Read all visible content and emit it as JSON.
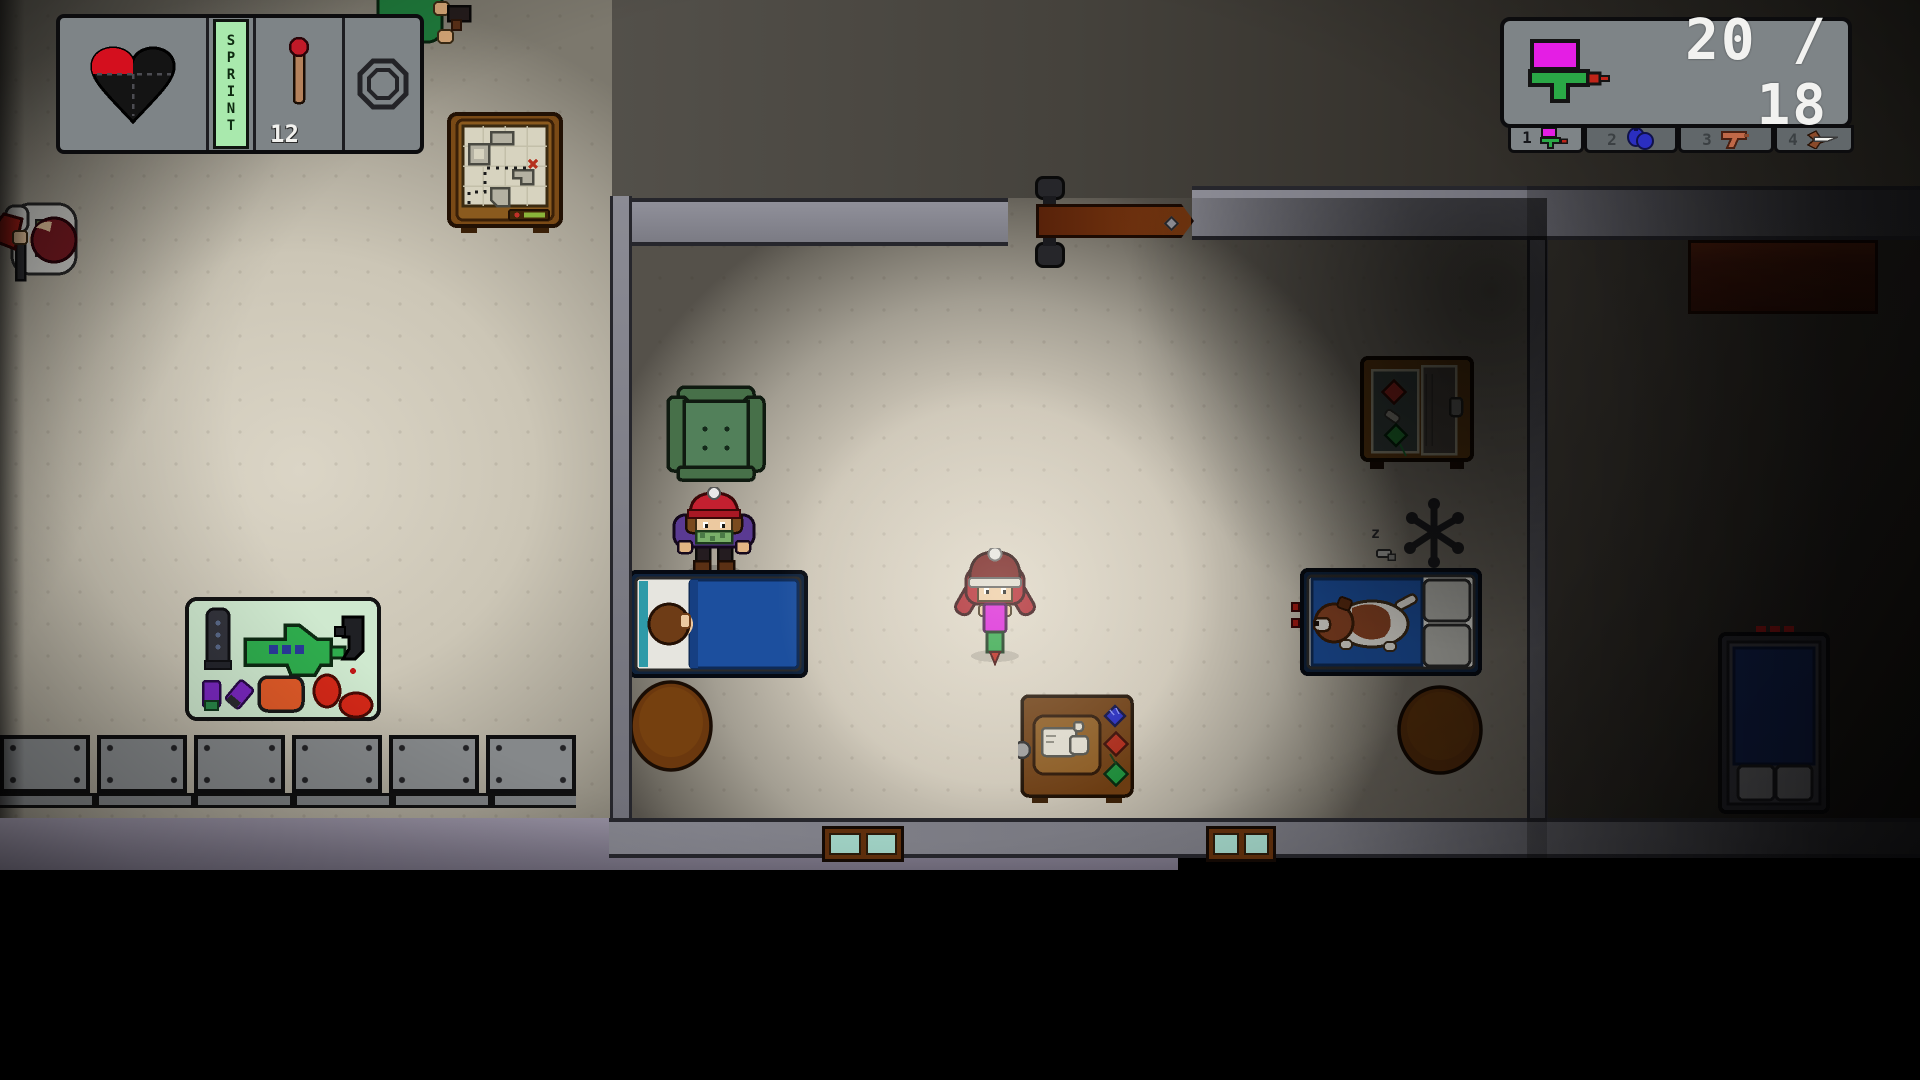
{
  "hud": {
    "status_panel": {
      "health_icon": "quartered-heart",
      "sprint_label": "SPRINT",
      "match_count": "12",
      "gear_icon": "octagon-ring"
    },
    "ammo_panel": {
      "weapon_icon": "watergun",
      "ammo_text": "20 / 18",
      "slots": [
        {
          "number": "1",
          "item_icon": "watergun",
          "active": true
        },
        {
          "number": "2",
          "item_icon": "water-balloons",
          "active": false
        },
        {
          "number": "3",
          "item_icon": "toy-pistol",
          "active": false
        },
        {
          "number": "4",
          "item_icon": "dart",
          "active": false
        }
      ]
    }
  },
  "world": {
    "dog_sleep_z_small": "z",
    "dog_sleep_z_large": "z"
  },
  "colors": {
    "hud_panel_gray": "#7e8487",
    "sprint_green": "#a9e9ad",
    "heart_red": "#d40f1e",
    "ammo_text_white": "#f2f2f0",
    "watergun_magenta": "#e41ee4",
    "watergun_green": "#2aa846",
    "bed_blue": "#1c4f9e",
    "floor_beige": "#cfc8b8",
    "wall_gray": "#85858e"
  }
}
